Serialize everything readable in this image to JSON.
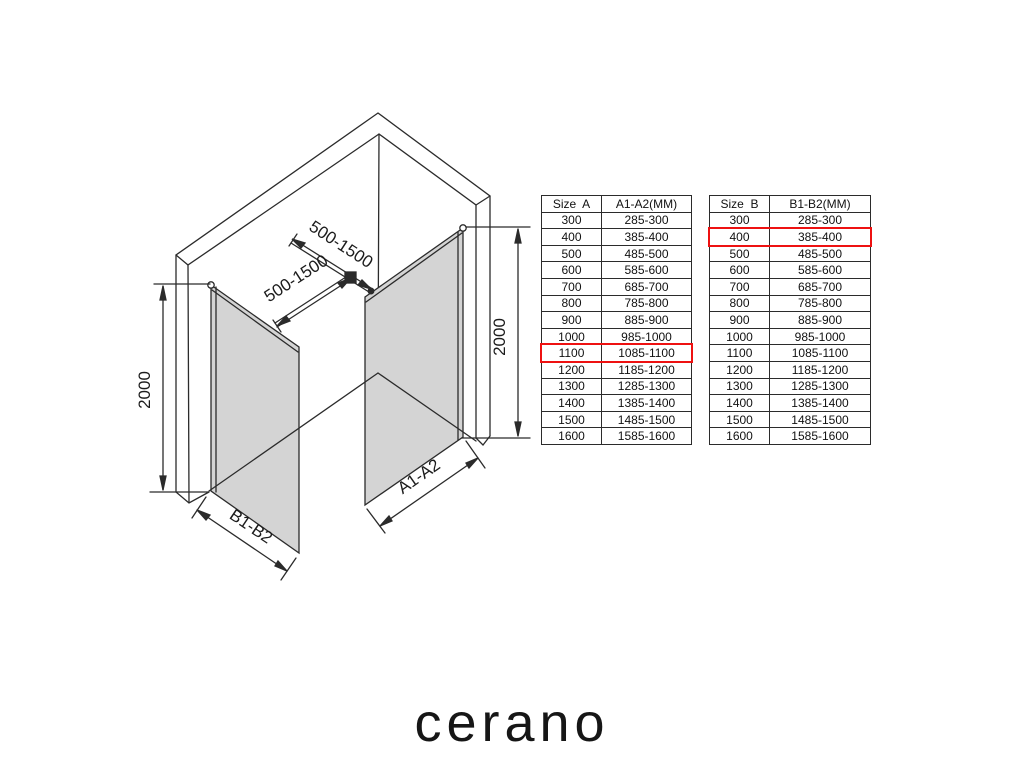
{
  "diagram": {
    "labels": {
      "height_left": "2000",
      "height_right": "2000",
      "bar_upper": "500-1500",
      "bar_lower": "500-1500",
      "panel_b": "B1-B2",
      "panel_a": "A1-A2"
    },
    "colors": {
      "line": "#2b2b2b",
      "glass_fill": "#d4d4d4",
      "highlight": "#ee1111"
    }
  },
  "tables": [
    {
      "headers": [
        "Size  A",
        "A1-A2(MM)"
      ],
      "highlight_row": "1100",
      "rows": [
        [
          "300",
          "285-300"
        ],
        [
          "400",
          "385-400"
        ],
        [
          "500",
          "485-500"
        ],
        [
          "600",
          "585-600"
        ],
        [
          "700",
          "685-700"
        ],
        [
          "800",
          "785-800"
        ],
        [
          "900",
          "885-900"
        ],
        [
          "1000",
          "985-1000"
        ],
        [
          "1100",
          "1085-1100"
        ],
        [
          "1200",
          "1185-1200"
        ],
        [
          "1300",
          "1285-1300"
        ],
        [
          "1400",
          "1385-1400"
        ],
        [
          "1500",
          "1485-1500"
        ],
        [
          "1600",
          "1585-1600"
        ]
      ]
    },
    {
      "headers": [
        "Size  B",
        "B1-B2(MM)"
      ],
      "highlight_row": "400",
      "rows": [
        [
          "300",
          "285-300"
        ],
        [
          "400",
          "385-400"
        ],
        [
          "500",
          "485-500"
        ],
        [
          "600",
          "585-600"
        ],
        [
          "700",
          "685-700"
        ],
        [
          "800",
          "785-800"
        ],
        [
          "900",
          "885-900"
        ],
        [
          "1000",
          "985-1000"
        ],
        [
          "1100",
          "1085-1100"
        ],
        [
          "1200",
          "1185-1200"
        ],
        [
          "1300",
          "1285-1300"
        ],
        [
          "1400",
          "1385-1400"
        ],
        [
          "1500",
          "1485-1500"
        ],
        [
          "1600",
          "1585-1600"
        ]
      ]
    }
  ],
  "brand": {
    "logo_text": "cerano"
  }
}
